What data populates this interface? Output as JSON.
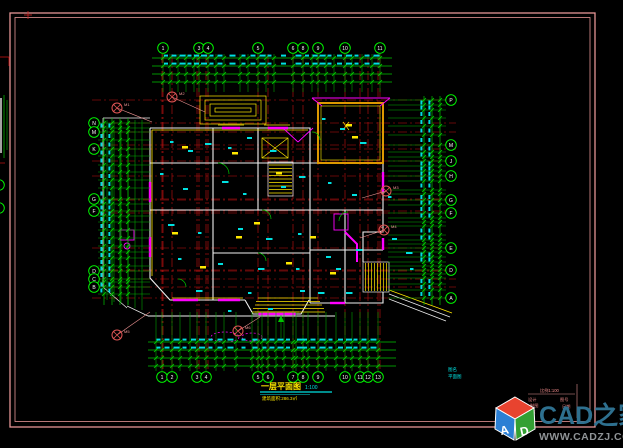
{
  "drawing": {
    "type": "architectural floor plan",
    "background": "#000000",
    "frame_color": "#e59595"
  },
  "axis": {
    "top": [
      {
        "label": "1",
        "x": 163
      },
      {
        "label": "3",
        "x": 199
      },
      {
        "label": "4",
        "x": 208
      },
      {
        "label": "5",
        "x": 258
      },
      {
        "label": "6",
        "x": 293
      },
      {
        "label": "8",
        "x": 303
      },
      {
        "label": "9",
        "x": 318
      },
      {
        "label": "10",
        "x": 345
      },
      {
        "label": "11",
        "x": 380
      }
    ],
    "bottom": [
      {
        "label": "1",
        "x": 162
      },
      {
        "label": "2",
        "x": 172
      },
      {
        "label": "3",
        "x": 197
      },
      {
        "label": "4",
        "x": 206
      },
      {
        "label": "5",
        "x": 258
      },
      {
        "label": "6",
        "x": 268
      },
      {
        "label": "7",
        "x": 293
      },
      {
        "label": "8",
        "x": 303
      },
      {
        "label": "9",
        "x": 318
      },
      {
        "label": "10",
        "x": 345
      },
      {
        "label": "11",
        "x": 360
      },
      {
        "label": "12",
        "x": 368
      },
      {
        "label": "13",
        "x": 378
      }
    ],
    "left": [
      {
        "label": "N",
        "y": 123
      },
      {
        "label": "M",
        "y": 132
      },
      {
        "label": "K",
        "y": 149
      },
      {
        "label": "G",
        "y": 199
      },
      {
        "label": "F",
        "y": 211
      },
      {
        "label": "D",
        "y": 271
      },
      {
        "label": "C",
        "y": 279
      },
      {
        "label": "B",
        "y": 287
      }
    ],
    "right": [
      {
        "label": "P",
        "y": 100
      },
      {
        "label": "M",
        "y": 145
      },
      {
        "label": "J",
        "y": 161
      },
      {
        "label": "H",
        "y": 176
      },
      {
        "label": "G",
        "y": 200
      },
      {
        "label": "F",
        "y": 213
      },
      {
        "label": "E",
        "y": 248
      },
      {
        "label": "D",
        "y": 270
      },
      {
        "label": "A",
        "y": 298
      }
    ]
  },
  "callouts": [
    {
      "label": "M1",
      "x": 117,
      "y": 108,
      "lx": 152,
      "ly": 122
    },
    {
      "label": "M2",
      "x": 172,
      "y": 97,
      "lx": 205,
      "ly": 112
    },
    {
      "label": "M3",
      "x": 386,
      "y": 191,
      "lx": 362,
      "ly": 198
    },
    {
      "label": "M4",
      "x": 384,
      "y": 230,
      "lx": 360,
      "ly": 238
    },
    {
      "label": "M5",
      "x": 117,
      "y": 335,
      "lx": 150,
      "ly": 312
    },
    {
      "label": "M6",
      "x": 238,
      "y": 331,
      "lx": 260,
      "ly": 317
    }
  ],
  "title": {
    "main": "一层平面图",
    "scale": "1:100",
    "subtitle": "建筑面积:286.3㎡"
  },
  "sheet_note": {
    "line1": "图名",
    "line2": "平面图"
  },
  "title_block": {
    "heading": "比例1:100",
    "rows_left": [
      "设计",
      "制图",
      "审核"
    ],
    "rows_right": [
      "图号",
      "日期"
    ]
  },
  "watermark": {
    "brand": "CAD之家",
    "url": "WWW.CADZJ.COM",
    "logo_a": "A",
    "logo_d": "D",
    "brand_color": "#2e708f",
    "url_color": "#8f9396"
  }
}
